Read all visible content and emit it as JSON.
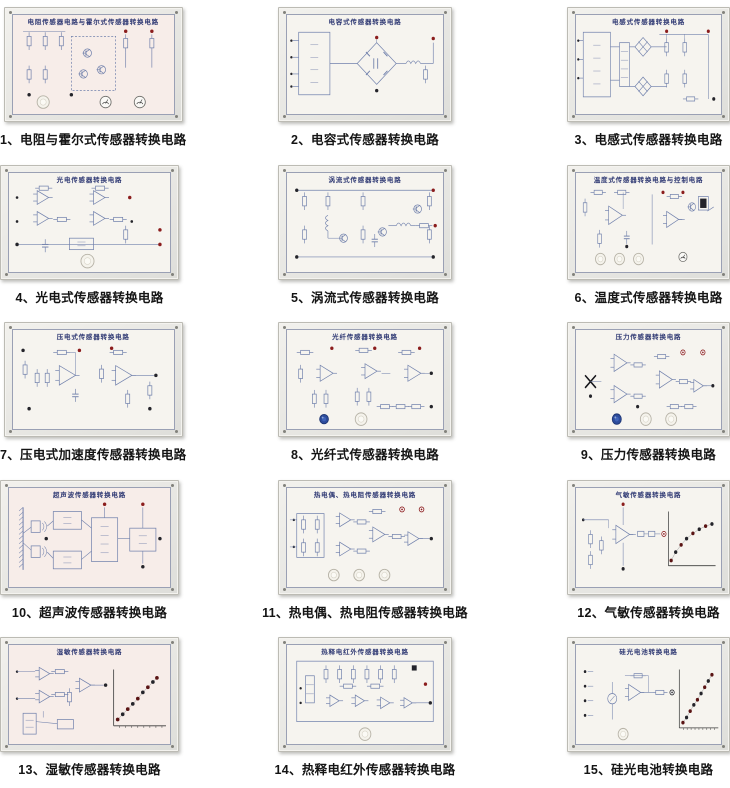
{
  "page": {
    "background": "#ffffff",
    "kind": "sensor training circuit board catalog, 3 columns x 5 rows"
  },
  "colors": {
    "schematic_line": "#7181ac",
    "board_title": "#303a74",
    "caption_text": "#141414",
    "terminal_red": "#8b1d1d",
    "terminal_dark": "#24242a",
    "graph_dot": "#5a1414",
    "axis": "#3c3c3c",
    "knob_blue": "#2d4c9c",
    "panel_face": "#f6f4ef",
    "panel_face_pink": "#f7ede9"
  },
  "items": [
    {
      "index": "1",
      "label": "1、电阻与霍尔式传感器转换电路",
      "board_title": "电阻传感器电路与霍尔式传感器转换电路",
      "sketch": "resistance-hall-circuit",
      "tint": "pink",
      "knobs": [
        {
          "kind": "knob",
          "color": "white"
        },
        {
          "kind": "meter"
        },
        {
          "kind": "meter"
        }
      ]
    },
    {
      "index": "2",
      "label": "2、电容式传感器转换电路",
      "board_title": "电容式传感器转换电路",
      "sketch": "capacitive-bridge",
      "tint": "",
      "knobs": []
    },
    {
      "index": "3",
      "label": "3、电感式传感器转换电路",
      "board_title": "电感式传感器转换电路",
      "sketch": "inductive-circuit",
      "tint": "",
      "knobs": []
    },
    {
      "index": "4",
      "label": "4、光电式传感器转换电路",
      "board_title": "光电传感器转换电路",
      "sketch": "photoelectric-opamps",
      "tint": "",
      "knobs": [
        {
          "kind": "knob",
          "color": "white"
        }
      ]
    },
    {
      "index": "5",
      "label": "5、涡流式传感器转换电路",
      "board_title": "涡流式传感器转换电路",
      "sketch": "eddy-current-transistors",
      "tint": "",
      "knobs": []
    },
    {
      "index": "6",
      "label": "6、温度式传感器转换电路",
      "board_title": "温度式传感器转换电路与控制电路",
      "sketch": "temperature-control",
      "tint": "",
      "knobs": [
        {
          "kind": "knob",
          "color": "white"
        },
        {
          "kind": "knob",
          "color": "white"
        },
        {
          "kind": "knob",
          "color": "white"
        },
        {
          "kind": "meter"
        }
      ]
    },
    {
      "index": "7",
      "label": "7、压电式加速度传感器转换电路",
      "board_title": "压电式传感器转换电路",
      "sketch": "piezoelectric-amplifiers",
      "tint": "",
      "knobs": []
    },
    {
      "index": "8",
      "label": "8、光纤式传感器转换电路",
      "board_title": "光纤传感器转换电路",
      "sketch": "fiber-optic-opamps",
      "tint": "",
      "knobs": [
        {
          "kind": "knob",
          "color": "blue"
        },
        {
          "kind": "knob",
          "color": "white"
        }
      ]
    },
    {
      "index": "9",
      "label": "9、压力传感器转换电路",
      "board_title": "压力传感器转换电路",
      "sketch": "pressure-opamps",
      "tint": "",
      "knobs": [
        {
          "kind": "knob",
          "color": "blue"
        },
        {
          "kind": "knob",
          "color": "white"
        },
        {
          "kind": "knob",
          "color": "white"
        }
      ]
    },
    {
      "index": "10",
      "label": "10、超声波传感器转换电路",
      "board_title": "超声波传感器转换电路",
      "sketch": "ultrasonic-blocks",
      "tint": "pink",
      "knobs": []
    },
    {
      "index": "11",
      "label": "11、热电偶、热电阻传感器转换电路",
      "board_title": "热电偶、热电阻传感器转换电路",
      "sketch": "thermocouple-bridge-opamps",
      "tint": "",
      "knobs": [
        {
          "kind": "knob",
          "color": "white"
        },
        {
          "kind": "knob",
          "color": "white"
        },
        {
          "kind": "knob",
          "color": "white"
        }
      ]
    },
    {
      "index": "12",
      "label": "12、气敏传感器转换电路",
      "board_title": "气敏传感器转换电路",
      "sketch": "gas-sensor-curve",
      "tint": "",
      "knobs": [],
      "graph": {
        "type": "scatter",
        "trend": "saturating-rise"
      }
    },
    {
      "index": "13",
      "label": "13、湿敏传感器转换电路",
      "board_title": "湿敏传感器转换电路",
      "sketch": "humidity-linear-graph",
      "tint": "pink",
      "knobs": [],
      "graph": {
        "type": "scatter",
        "trend": "linear-rise"
      }
    },
    {
      "index": "14",
      "label": "14、热释电红外传感器转换电路",
      "board_title": "热释电红外传感器转换电路",
      "sketch": "pyroelectric-dense",
      "tint": "",
      "knobs": [
        {
          "kind": "knob",
          "color": "white"
        }
      ]
    },
    {
      "index": "15",
      "label": "15、硅光电池转换电路",
      "board_title": "硅光电池转换电路",
      "sketch": "silicon-cell-linear-graph",
      "tint": "",
      "knobs": [
        {
          "kind": "knob",
          "color": "white"
        }
      ],
      "graph": {
        "type": "scatter",
        "trend": "linear-rise"
      }
    }
  ]
}
